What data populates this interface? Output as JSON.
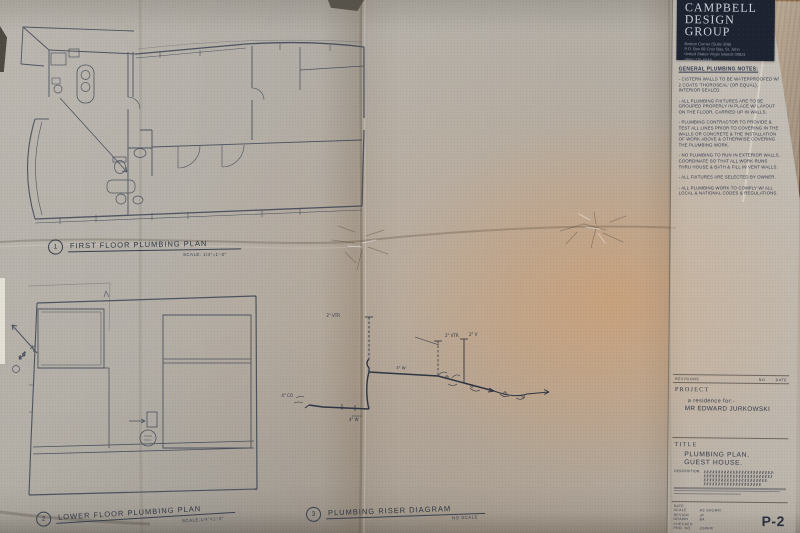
{
  "sheet": {
    "number": "P-2"
  },
  "firm": {
    "name_lines": [
      "CAMPBELL",
      "DESIGN",
      "GROUP"
    ],
    "address_lines": [
      "Boston Corner (Suite 308)",
      "P.O. Box 68 Cruz Bay, St. John",
      "United States Virgin Islands 00831",
      "(809) 776-6548"
    ]
  },
  "notes": {
    "title": "GENERAL PLUMBING NOTES:",
    "items": [
      "- CISTERN WALLS TO BE WATERPROOFED W/ 2 COATS 'THOROSEAL' (OR EQUAL), INTERIOR SEALED.",
      "- ALL PLUMBING FIXTURES ARE TO BE GROUPED PROPERLY IN PLACE W/ LAYOUT ON THE FLOOR, CARRIED UP IN WALLS.",
      "- PLUMBING CONTRACTOR TO PROVIDE & TEST ALL LINES PRIOR TO COVERING IN THE WALLS OR CONCRETE & THE INSTALLATION OF WORK ABOVE & OTHERWISE COVERING THE PLUMBING WORK.",
      "- NO PLUMBING TO RUN IN EXTERIOR WALLS. COORDINATE SO THAT ALL WORK RUNS THRU HOUSE & BATH & FILL IN VENT WALLS.",
      "- ALL FIXTURES ARE SELECTED BY OWNER.",
      "- ALL PLUMBING WORK TO COMPLY W/ ALL LOCAL & NATIONAL CODES & REGULATIONS."
    ]
  },
  "revisions": {
    "label": "REVISIONS",
    "no": "NO.",
    "date": "DATE"
  },
  "project": {
    "label": "PROJECT",
    "line1": "a residence for:-",
    "line2": "MR EDWARD JURKOWSKI"
  },
  "title_block": {
    "label": "TITLE",
    "line1": "PLUMBING PLAN.",
    "line2": "GUEST HOUSE.",
    "description_label": "DESCRIPTION:"
  },
  "info": {
    "rows": [
      {
        "label": "DATE",
        "value": ""
      },
      {
        "label": "SCALE",
        "value": "AS SHOWN"
      },
      {
        "label": "DESIGN",
        "value": "JF"
      },
      {
        "label": "DRAWN",
        "value": "BA"
      },
      {
        "label": "CHECKED",
        "value": ""
      },
      {
        "label": "PRO. NO.",
        "value": "JURKW"
      }
    ]
  },
  "plans": [
    {
      "number": "1",
      "title": "FIRST FLOOR PLUMBING PLAN",
      "scale": "SCALE: 1/4\"=1'-0\""
    },
    {
      "number": "2",
      "title": "LOWER FLOOR PLUMBING PLAN",
      "scale": "SCALE:1/4\"=1'-0\""
    },
    {
      "number": "3",
      "title": "PLUMBING RISER DIAGRAM",
      "scale": "NO SCALE"
    }
  ],
  "riser": {
    "annotations": [
      "2\" VTR",
      "2\" VTR",
      "2\" V",
      "3\" W",
      "4\" CO",
      "4\" W"
    ]
  },
  "plan2": {
    "annotations": [
      "4'-0\""
    ]
  },
  "colors": {
    "paper": "#b3aea6",
    "peach": "#d69860",
    "ink": "#3c4453",
    "firm_box": "#1d2330",
    "wood": "#8a6845"
  }
}
